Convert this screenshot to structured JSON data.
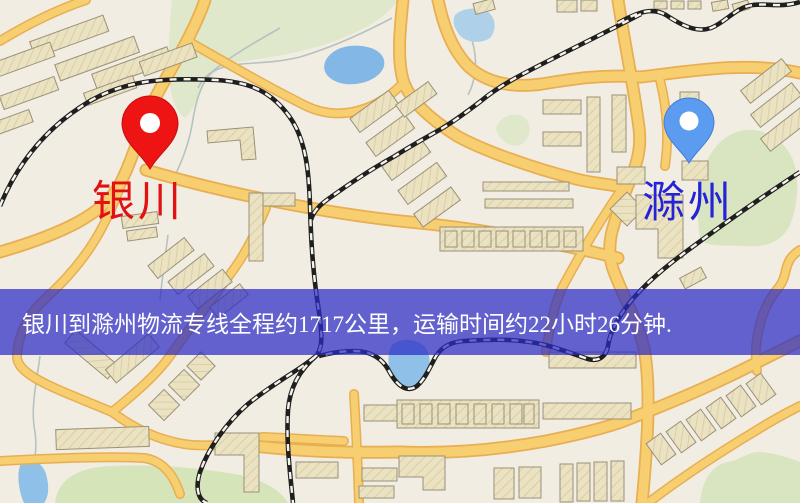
{
  "map": {
    "origin": {
      "label": "银川",
      "label_color": "#E01212",
      "pin_color": "#EE1414",
      "pin_edge_color": "#C40D0D"
    },
    "destination": {
      "label": "滁州",
      "label_color": "#2424D6",
      "pin_color": "#5B9CF1",
      "pin_edge_color": "#3F7FD8"
    },
    "banner": {
      "text": "银川到滁州物流专线全程约1717公里，运输时间约22小时26分钟.",
      "background": "#2B2BC5",
      "text_color": "#FFFFFF",
      "distance_km": "1717",
      "duration": "22小时26分钟"
    },
    "legend_colors": {
      "background": "#F1EDE3",
      "road_fill": "#F7CF70",
      "road_casing": "#E8AE52",
      "park_green": "#DFE8CB",
      "water_blue": "#86B9E7",
      "building": "#EBE2C2",
      "railway": "#222222"
    }
  }
}
